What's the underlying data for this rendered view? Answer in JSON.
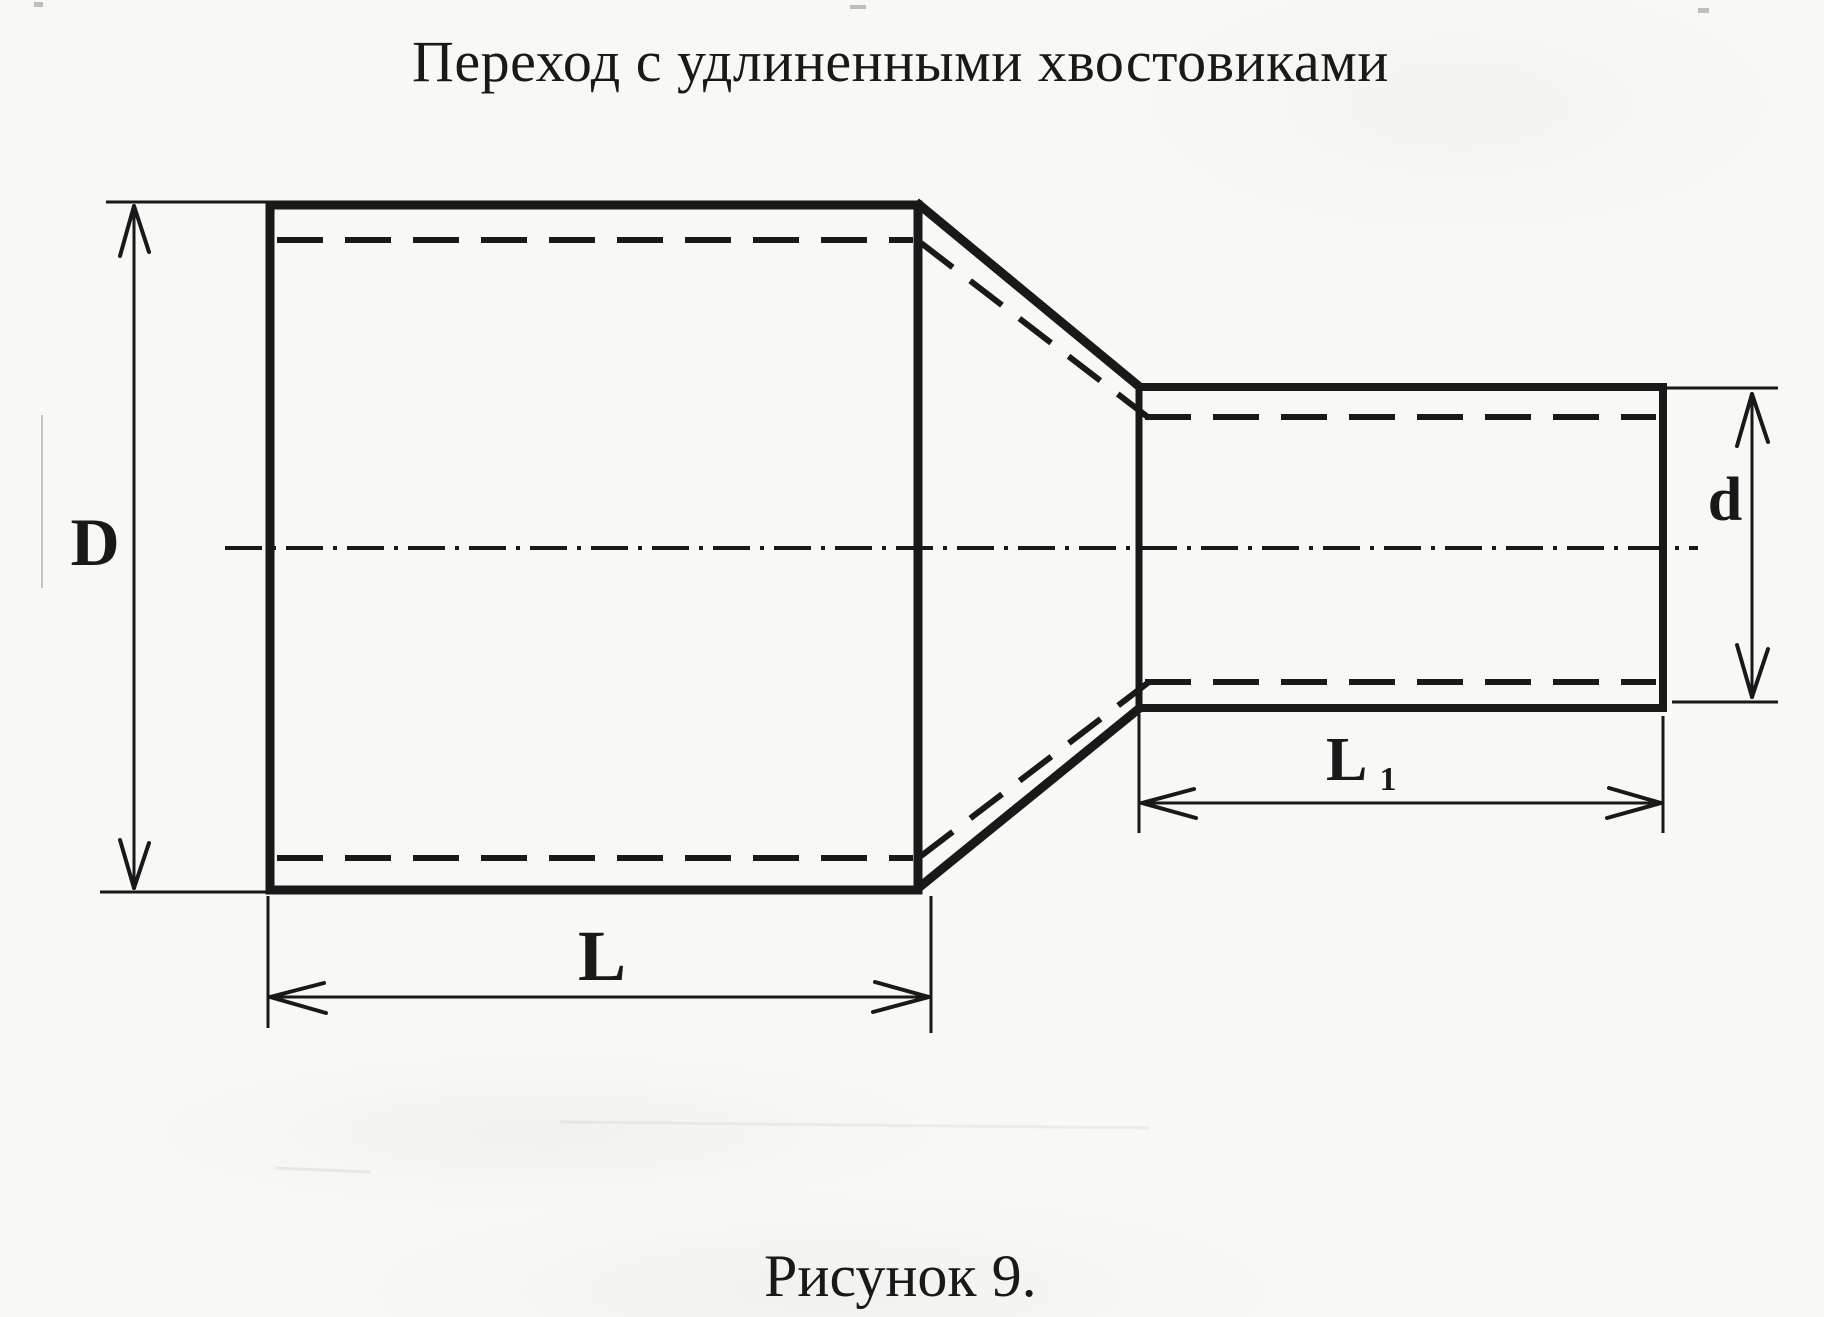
{
  "title": "Переход с удлиненными хвостовиками",
  "caption": "Рисунок 9.",
  "labels": {
    "large_diameter": "D",
    "large_length": "L",
    "small_length_main": "L",
    "small_length_sub": "1",
    "small_diameter": "d"
  },
  "colors": {
    "ink": "#191919",
    "paper": "#f8f8f5"
  }
}
